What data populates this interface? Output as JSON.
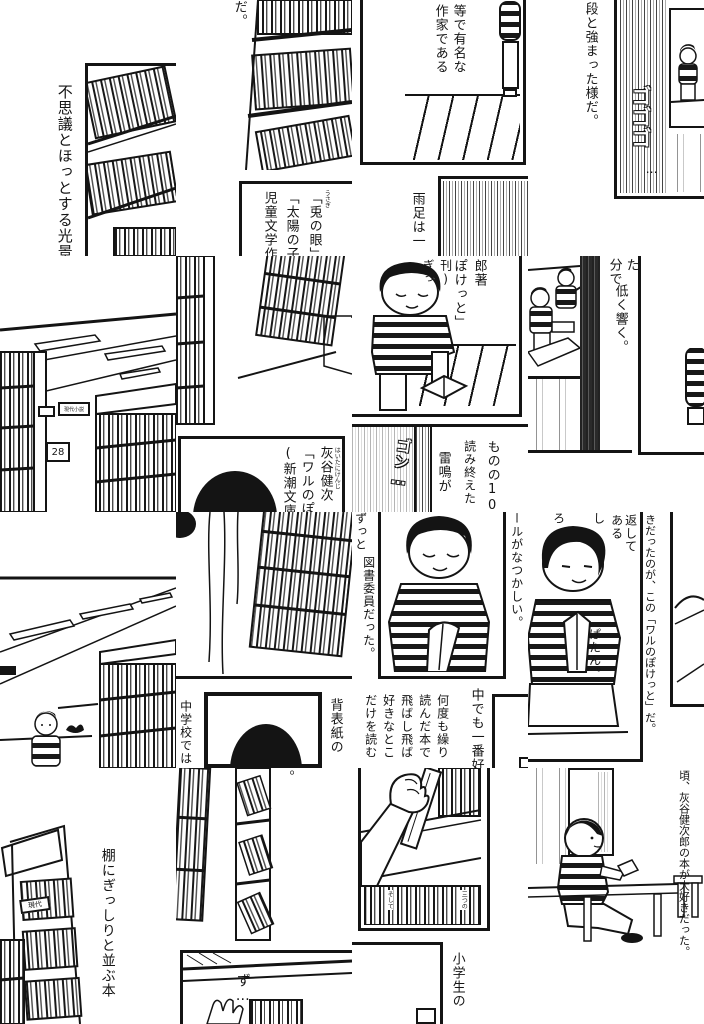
{
  "t1": {
    "caption": "不思議とほっとする光景"
  },
  "t2": {
    "fragment": "だ。",
    "title1": "「兎の眼」",
    "furigana": "うさぎ",
    "title2": "「太陽の子",
    "title3": "児童文学作"
  },
  "t3": {
    "line1": "等で有名な",
    "line2": "作家である",
    "rain": "雨足は一"
  },
  "t4": {
    "line": "段と強まった様だ。",
    "sfx": "ゴゴゴ",
    "sfx_tail": "…"
  },
  "t5": {
    "shelf_number": "28",
    "shelf_sign": "現代小説"
  },
  "t6": {
    "author": "灰谷健次",
    "furigana": "はいたにけんじ",
    "title": "「ワルのぽ",
    "publisher": "(新潮文庫"
  },
  "t7": {
    "author_cont": "郎著",
    "title_cont": "ぽけっと」",
    "publisher_cont": "刊)",
    "sfx_creak": "ぎっ",
    "sfx_thunder": "ゴン…",
    "thunder": "雷鳴が",
    "read1": "ものの10",
    "read2": "読み終えた"
  },
  "t8": {
    "read_cont": "分で",
    "read_tail": "た",
    "thunder_cont": "低く響く。"
  },
  "t10": {
    "school": "中学校では",
    "spine": "背表紙の"
  },
  "t11": {
    "left1": "ずっと",
    "left2": "図書委員だった。",
    "right": "ールがなつかしい。",
    "fav": "中でも一番好",
    "re1": "何度も繰り",
    "re2": "読んだ本で",
    "re3": "飛ばし飛ば",
    "re4": "好きなとこ",
    "re5": "だけを読む"
  },
  "t12": {
    "r1": "返して",
    "r2": "ある",
    "f1": "し",
    "f2": "ろ",
    "sfx": "ぱたん。",
    "long": "きだったのが、この「ワルのぽけっと」だ。"
  },
  "t13": {
    "caption": "棚にぎっしりと並ぶ本",
    "sign": "現代"
  },
  "t14": {
    "period": "。",
    "sfx": "ず…"
  },
  "t15": {
    "spine1": "そして",
    "spine2": "三つの",
    "text": "小学生の"
  },
  "t16": {
    "text": "頃、灰谷健次郎の本が大好きだった。"
  },
  "colors": {
    "ink": "#141414",
    "paper": "#ffffff"
  }
}
